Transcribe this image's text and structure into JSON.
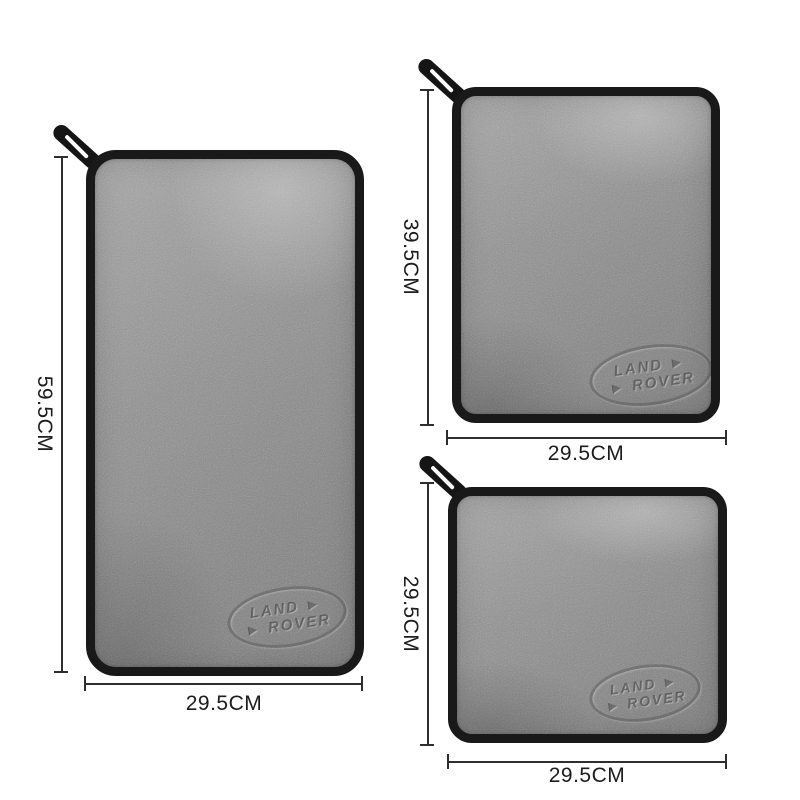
{
  "page": {
    "description": "Product photo of three grey Land Rover microfibre towels with size dimension annotations",
    "background_color": "#ffffff"
  },
  "brand": {
    "logo_line1": "LAND ►",
    "logo_line2": "► ROVER"
  },
  "colors": {
    "fabric_gray": "#8f8f8f",
    "trim_black": "#191919",
    "dimension_line": "#2e2e2e",
    "label_text": "#1c1c1c"
  },
  "towels": [
    {
      "id": "large",
      "height_label": "59.5CM",
      "width_label": "29.5CM"
    },
    {
      "id": "medium",
      "height_label": "39.5CM",
      "width_label": "29.5CM"
    },
    {
      "id": "small",
      "height_label": "29.5CM",
      "width_label": "29.5CM"
    }
  ]
}
